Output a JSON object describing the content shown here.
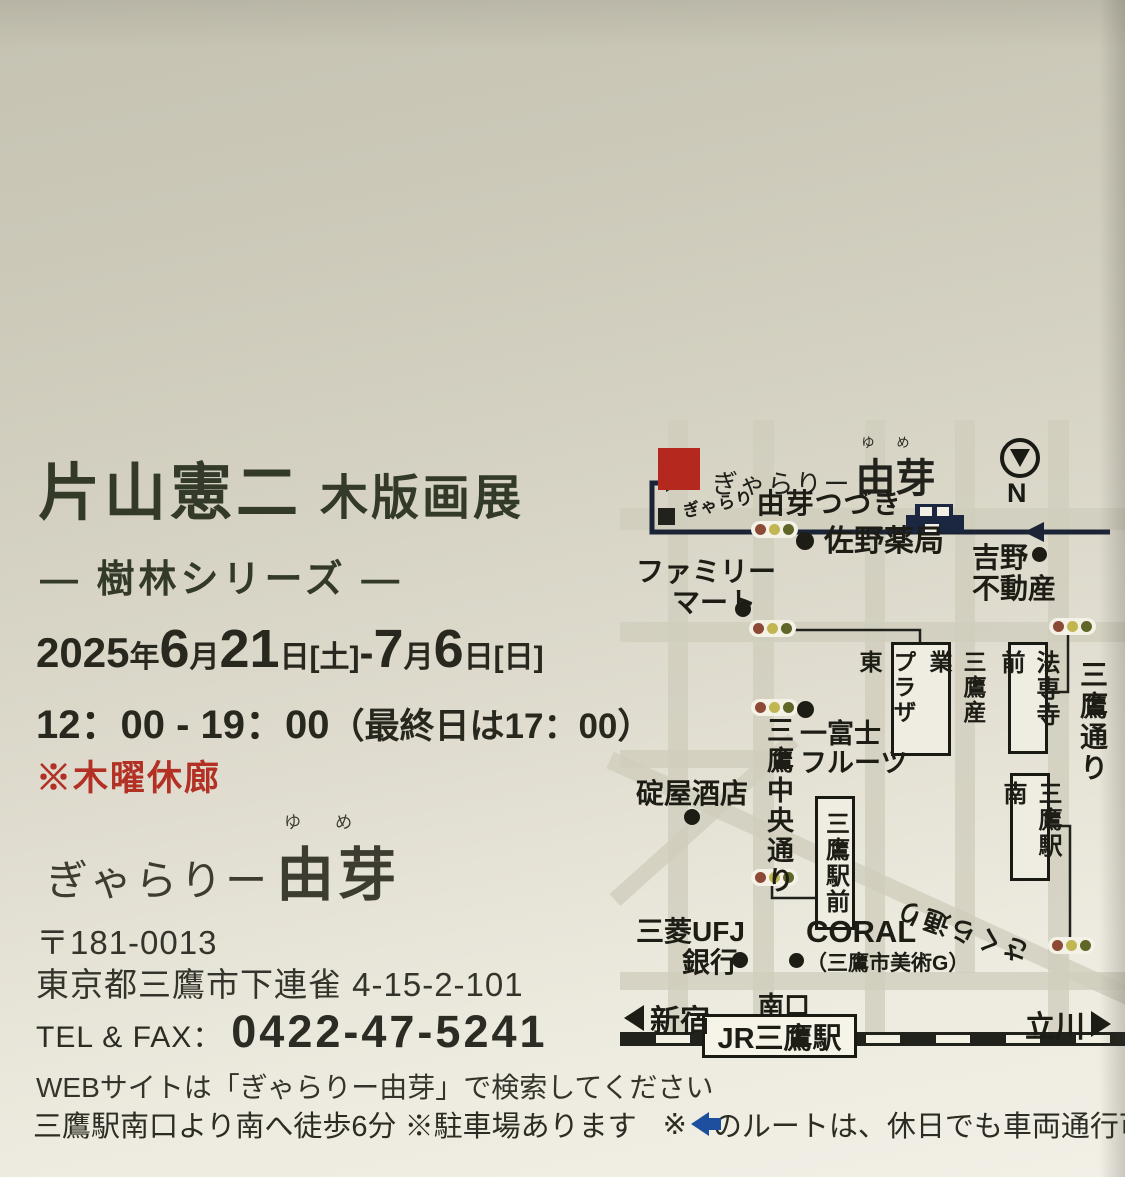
{
  "flyer": {
    "title_name": "片山憲二",
    "title_type": "木版画展",
    "subtitle": "― 樹林シリーズ ―",
    "date_parts": [
      "2025",
      "年",
      "6",
      "月",
      "21",
      "日[土]",
      " - ",
      "7",
      "月",
      "6",
      "日[日]"
    ],
    "time_main": "12：00 - 19：00",
    "time_note": "（最終日は17：00）",
    "closed_notice": "※木曜休廊",
    "logo": {
      "script": "ぎゃらりー",
      "name": "由芽",
      "furigana": "ゆめ"
    },
    "postal": "〒181-0013",
    "address": "東京都三鷹市下連雀 4-15-2-101",
    "tel_label": "TEL & FAX：",
    "tel_number": "0422-47-5241",
    "web_note": "WEBサイトは「ぎゃらりー由芽」で検索してください",
    "access_1": "三鷹駅南口より南へ徒歩6分 ※駐車場あります",
    "access_2": "※",
    "access_3": "のルートは、休日でも車両通行可"
  },
  "map": {
    "gallery_main": {
      "script": "ぎゃらりー",
      "name": "由芽",
      "furigana": "ゆめ"
    },
    "gallery_annex": {
      "script": "ぎゃらり",
      "name": "由芽つづき"
    },
    "compass_label": "N",
    "places": [
      {
        "name": "佐野薬局"
      },
      {
        "line1": "ファミリー",
        "line2": "マート"
      },
      {
        "line1": "吉野",
        "line2": "不動産"
      },
      {
        "line1": "一富士",
        "line2": "フルーツ"
      },
      {
        "name": "碇屋酒店"
      },
      {
        "line1": "三菱UFJ",
        "line2": "銀行"
      },
      {
        "line1": "CORAL",
        "line2": "（三鷹市美術G）"
      }
    ],
    "boxes": {
      "plaza_col1": "三鷹産業",
      "plaza_col2": "プラザ東",
      "hosenji": "法専寺前",
      "ekimae": "三鷹駅前",
      "ekiminami": "三鷹駅南"
    },
    "streets": {
      "chuo_dori": "三鷹中央通り",
      "mitaka_dori": "三鷹通り",
      "sakura_dori": "さくら通り"
    },
    "station": {
      "name": "JR三鷹駅",
      "south_exit": "南口",
      "west": "新宿",
      "east": "立川"
    }
  },
  "colors": {
    "gallery_marker_red": "#b5281d",
    "notice_red": "#b23024",
    "route_navy": "#1b2336",
    "holiday_route_blue": "#1d4f9e",
    "title_green": "#333a29",
    "paper_top": "#c5c2b2",
    "paper_bottom": "#f2f0e6"
  }
}
